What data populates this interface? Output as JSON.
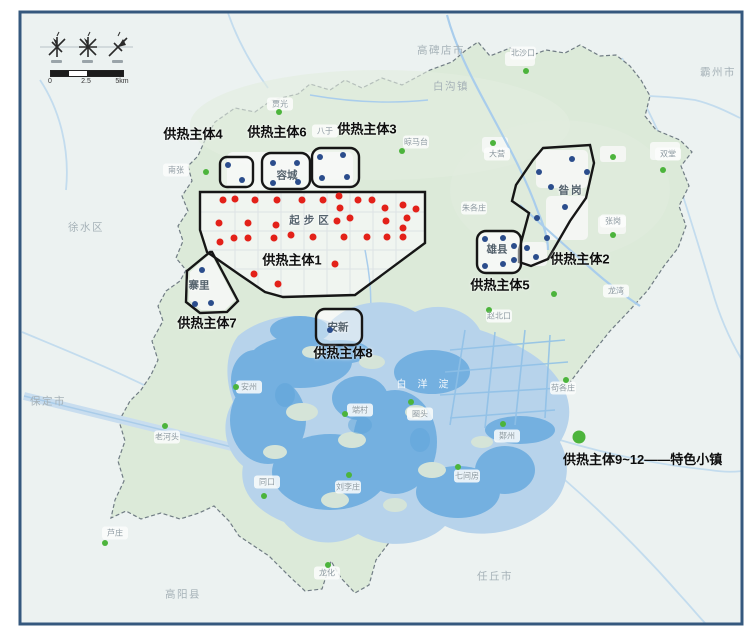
{
  "frame": {
    "border_color": "#35587e"
  },
  "legend": {
    "text": "供热主体9~12——特色小镇",
    "x": 563,
    "y": 449,
    "dot": [
      579,
      437
    ]
  },
  "scalebar": {
    "labels": [
      "0",
      "2.5",
      "5km"
    ]
  },
  "map": {
    "colors": {
      "red": "#e32119",
      "blue": "#2b4d8c",
      "green": "#4cb43c"
    },
    "entity_labels": [
      {
        "text": "供热主体4",
        "x": 193,
        "y": 133
      },
      {
        "text": "供热主体6",
        "x": 277,
        "y": 131
      },
      {
        "text": "供热主体3",
        "x": 367,
        "y": 128
      },
      {
        "text": "供热主体1",
        "x": 292,
        "y": 259
      },
      {
        "text": "供热主体7",
        "x": 207,
        "y": 322
      },
      {
        "text": "供热主体8",
        "x": 343,
        "y": 352
      },
      {
        "text": "供热主体5",
        "x": 500,
        "y": 284
      },
      {
        "text": "供热主体2",
        "x": 580,
        "y": 258
      }
    ],
    "zone_labels": [
      {
        "text": "起步区",
        "x": 311,
        "y": 220,
        "ls": 4
      },
      {
        "text": "容城",
        "x": 287,
        "y": 175
      },
      {
        "text": "雄县",
        "x": 497,
        "y": 249
      },
      {
        "text": "安新",
        "x": 338,
        "y": 327
      },
      {
        "text": "昝岗",
        "x": 571,
        "y": 190,
        "ls": 2
      },
      {
        "text": "寨里",
        "x": 199,
        "y": 285
      }
    ],
    "district_labels": [
      {
        "text": "高碑店市",
        "x": 441,
        "y": 50
      },
      {
        "text": "白沟镇",
        "x": 451,
        "y": 86
      },
      {
        "text": "霸州市",
        "x": 718,
        "y": 72
      },
      {
        "text": "徐水区",
        "x": 86,
        "y": 227
      },
      {
        "text": "保定市",
        "x": 48,
        "y": 401
      },
      {
        "text": "高阳县",
        "x": 183,
        "y": 594
      },
      {
        "text": "任丘市",
        "x": 495,
        "y": 576
      }
    ],
    "lake_label": {
      "text": "白洋淀",
      "x": 428,
      "y": 383
    },
    "towns": [
      {
        "text": "北沙口",
        "x": 523,
        "y": 53,
        "dot": [
          526,
          71
        ]
      },
      {
        "text": "贾光",
        "x": 280,
        "y": 104,
        "dot": [
          279,
          112
        ]
      },
      {
        "text": "八于",
        "x": 325,
        "y": 131
      },
      {
        "text": "晾马台",
        "x": 416,
        "y": 142,
        "dot": [
          402,
          151
        ]
      },
      {
        "text": "南张",
        "x": 176,
        "y": 170,
        "dot": [
          206,
          172
        ]
      },
      {
        "text": "大营",
        "x": 497,
        "y": 154,
        "dot": [
          493,
          143
        ]
      },
      {
        "text": "双堂",
        "x": 668,
        "y": 154,
        "dot": [
          663,
          170
        ]
      },
      {
        "text": "朱各庄",
        "x": 474,
        "y": 208
      },
      {
        "text": "张岗",
        "x": 613,
        "y": 221,
        "dot": [
          613,
          235
        ]
      },
      {
        "text": "龙湾",
        "x": 616,
        "y": 291
      },
      {
        "text": "赵北口",
        "x": 499,
        "y": 316,
        "dot": [
          489,
          310
        ]
      },
      {
        "text": "苟各庄",
        "x": 563,
        "y": 388,
        "dot": [
          566,
          380
        ]
      },
      {
        "text": "鄚州",
        "x": 507,
        "y": 436,
        "dot": [
          503,
          424
        ]
      },
      {
        "text": "七间房",
        "x": 467,
        "y": 476,
        "dot": [
          458,
          467
        ]
      },
      {
        "text": "圈头",
        "x": 420,
        "y": 414,
        "dot": [
          411,
          402
        ]
      },
      {
        "text": "刘李庄",
        "x": 348,
        "y": 487,
        "dot": [
          349,
          475
        ]
      },
      {
        "text": "同口",
        "x": 267,
        "y": 482,
        "dot": [
          264,
          496
        ]
      },
      {
        "text": "老河头",
        "x": 167,
        "y": 437,
        "dot": [
          165,
          426
        ]
      },
      {
        "text": "安州",
        "x": 249,
        "y": 387,
        "dot": [
          236,
          387
        ]
      },
      {
        "text": "端村",
        "x": 360,
        "y": 410,
        "dot": [
          345,
          414
        ]
      },
      {
        "text": "芦庄",
        "x": 115,
        "y": 533,
        "dot": [
          105,
          543
        ]
      },
      {
        "text": "龙化",
        "x": 327,
        "y": 573,
        "dot": [
          328,
          565
        ]
      }
    ],
    "extra_green_dots": [
      [
        613,
        157
      ],
      [
        554,
        294
      ]
    ],
    "red_dots": [
      [
        223,
        200
      ],
      [
        235,
        199
      ],
      [
        255,
        200
      ],
      [
        277,
        200
      ],
      [
        302,
        200
      ],
      [
        323,
        200
      ],
      [
        339,
        196
      ],
      [
        340,
        208
      ],
      [
        358,
        200
      ],
      [
        372,
        200
      ],
      [
        385,
        208
      ],
      [
        403,
        205
      ],
      [
        416,
        209
      ],
      [
        219,
        223
      ],
      [
        248,
        223
      ],
      [
        276,
        225
      ],
      [
        291,
        235
      ],
      [
        313,
        237
      ],
      [
        337,
        221
      ],
      [
        350,
        218
      ],
      [
        386,
        221
      ],
      [
        407,
        218
      ],
      [
        220,
        242
      ],
      [
        234,
        238
      ],
      [
        248,
        238
      ],
      [
        274,
        238
      ],
      [
        344,
        237
      ],
      [
        367,
        237
      ],
      [
        387,
        237
      ],
      [
        403,
        228
      ],
      [
        403,
        237
      ],
      [
        335,
        264
      ],
      [
        254,
        274
      ],
      [
        278,
        284
      ]
    ],
    "blue_dots": [
      [
        228,
        165
      ],
      [
        242,
        180
      ],
      [
        273,
        163
      ],
      [
        297,
        163
      ],
      [
        273,
        183
      ],
      [
        298,
        182
      ],
      [
        320,
        157
      ],
      [
        343,
        155
      ],
      [
        322,
        178
      ],
      [
        347,
        177
      ],
      [
        485,
        239
      ],
      [
        503,
        238
      ],
      [
        514,
        246
      ],
      [
        485,
        266
      ],
      [
        503,
        264
      ],
      [
        514,
        260
      ],
      [
        330,
        330
      ],
      [
        202,
        270
      ],
      [
        195,
        304
      ],
      [
        211,
        303
      ],
      [
        572,
        159
      ],
      [
        539,
        172
      ],
      [
        587,
        172
      ],
      [
        551,
        187
      ],
      [
        565,
        207
      ],
      [
        537,
        218
      ],
      [
        547,
        238
      ],
      [
        527,
        248
      ],
      [
        536,
        257
      ]
    ]
  }
}
